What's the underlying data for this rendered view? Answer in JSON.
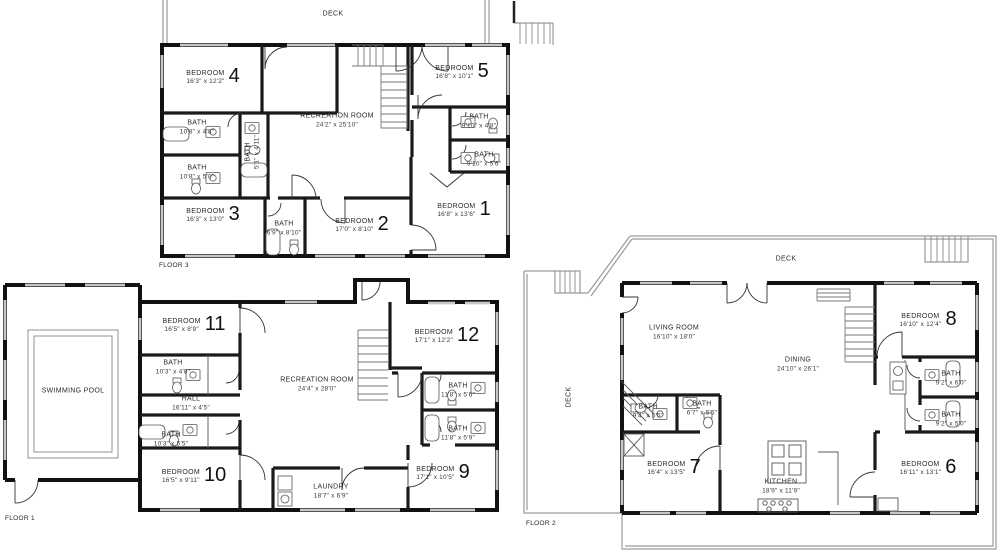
{
  "colors": {
    "wall": "#111111",
    "interior_wall": "#1a1a1a",
    "window": "#c6c6c6",
    "deck_line": "#9a9a9a",
    "text": "#222222",
    "background": "#ffffff"
  },
  "floors": [
    {
      "id": "floor3",
      "label": "FLOOR 3",
      "rooms": [
        {
          "name": "DECK",
          "x": 333,
          "y": 15
        },
        {
          "name": "BEDROOM",
          "num": "4",
          "dims": "16'3\" x 12'2\"",
          "x": 213,
          "y": 78
        },
        {
          "name": "BEDROOM",
          "num": "5",
          "dims": "16'8\" x 10'1\"",
          "x": 462,
          "y": 73
        },
        {
          "name": "RECREATION ROOM",
          "dims": "24'2\" x 25'10\"",
          "x": 337,
          "y": 121
        },
        {
          "name": "BATH",
          "dims": "10'8\" x 4'8\"",
          "x": 197,
          "y": 128
        },
        {
          "name": "BATH",
          "dims": "10'8\" x 5'0\"",
          "x": 197,
          "y": 173
        },
        {
          "name": "BATH",
          "dims": "5'1\" x 4'11\"",
          "x": 253,
          "y": 152,
          "vertical": true
        },
        {
          "name": "BATH",
          "dims": "9'10\" x 4'8\"",
          "x": 479,
          "y": 122
        },
        {
          "name": "BATH",
          "dims": "9'10\" x 5'6\"",
          "x": 484,
          "y": 160
        },
        {
          "name": "BEDROOM",
          "num": "3",
          "dims": "16'3\" x 13'0\"",
          "x": 213,
          "y": 216
        },
        {
          "name": "BATH",
          "dims": "6'9\" x 8'10\"",
          "x": 284,
          "y": 229
        },
        {
          "name": "BEDROOM",
          "num": "2",
          "dims": "17'0\" x 8'10\"",
          "x": 362,
          "y": 226
        },
        {
          "name": "BEDROOM",
          "num": "1",
          "dims": "16'8\" x 13'6\"",
          "x": 464,
          "y": 211
        }
      ]
    },
    {
      "id": "floor1",
      "label": "FLOOR 1",
      "rooms": [
        {
          "name": "SWIMMING POOL",
          "x": 73,
          "y": 392
        },
        {
          "name": "BEDROOM",
          "num": "11",
          "dims": "16'5\" x 8'9\"",
          "x": 194,
          "y": 326
        },
        {
          "name": "BATH",
          "dims": "10'3\" x 4'8\"",
          "x": 173,
          "y": 368
        },
        {
          "name": "HALL",
          "dims": "16'11\" x 4'5\"",
          "x": 191,
          "y": 404
        },
        {
          "name": "BATH",
          "dims": "10'3\" x 5'5\"",
          "x": 171,
          "y": 440
        },
        {
          "name": "BEDROOM",
          "num": "10",
          "dims": "16'5\" x 9'11\"",
          "x": 194,
          "y": 477
        },
        {
          "name": "RECREATION ROOM",
          "dims": "24'4\" x 28'0\"",
          "x": 317,
          "y": 385
        },
        {
          "name": "BEDROOM",
          "num": "12",
          "dims": "17'1\" x 12'2\"",
          "x": 447,
          "y": 337
        },
        {
          "name": "BATH",
          "dims": "11'8\" x 5'6\"",
          "x": 458,
          "y": 391
        },
        {
          "name": "BATH",
          "dims": "11'8\" x 5'9\"",
          "x": 458,
          "y": 434
        },
        {
          "name": "BEDROOM",
          "num": "9",
          "dims": "17'1\" x 10'5\"",
          "x": 443,
          "y": 474
        },
        {
          "name": "LAUNDRY",
          "dims": "18'7\" x 6'9\"",
          "x": 331,
          "y": 492
        }
      ]
    },
    {
      "id": "floor2",
      "label": "FLOOR 2",
      "rooms": [
        {
          "name": "DECK",
          "x": 786,
          "y": 260
        },
        {
          "name": "DECK",
          "x": 570,
          "y": 397,
          "vertical": true
        },
        {
          "name": "LIVING ROOM",
          "dims": "16'10\" x 18'0\"",
          "x": 674,
          "y": 333
        },
        {
          "name": "DINING",
          "dims": "24'10\" x 26'1\"",
          "x": 798,
          "y": 365
        },
        {
          "name": "BEDROOM",
          "num": "8",
          "dims": "16'10\" x 12'4\"",
          "x": 928,
          "y": 321
        },
        {
          "name": "BATH",
          "dims": "9'2\" x 6'0\"",
          "x": 951,
          "y": 379
        },
        {
          "name": "BATH",
          "dims": "9'2\" x 5'0\"",
          "x": 951,
          "y": 420
        },
        {
          "name": "BATH",
          "dims": "9'4\" x 5'5\"",
          "x": 648,
          "y": 412
        },
        {
          "name": "BATH",
          "dims": "6'7\" x 5'5\"",
          "x": 702,
          "y": 409
        },
        {
          "name": "BEDROOM",
          "num": "7",
          "dims": "16'4\" x 13'5\"",
          "x": 674,
          "y": 469
        },
        {
          "name": "KITCHEN",
          "dims": "18'9\" x 11'9\"",
          "x": 781,
          "y": 487
        },
        {
          "name": "BEDROOM",
          "num": "6",
          "dims": "16'11\" x 13'1\"",
          "x": 928,
          "y": 469
        }
      ]
    }
  ]
}
